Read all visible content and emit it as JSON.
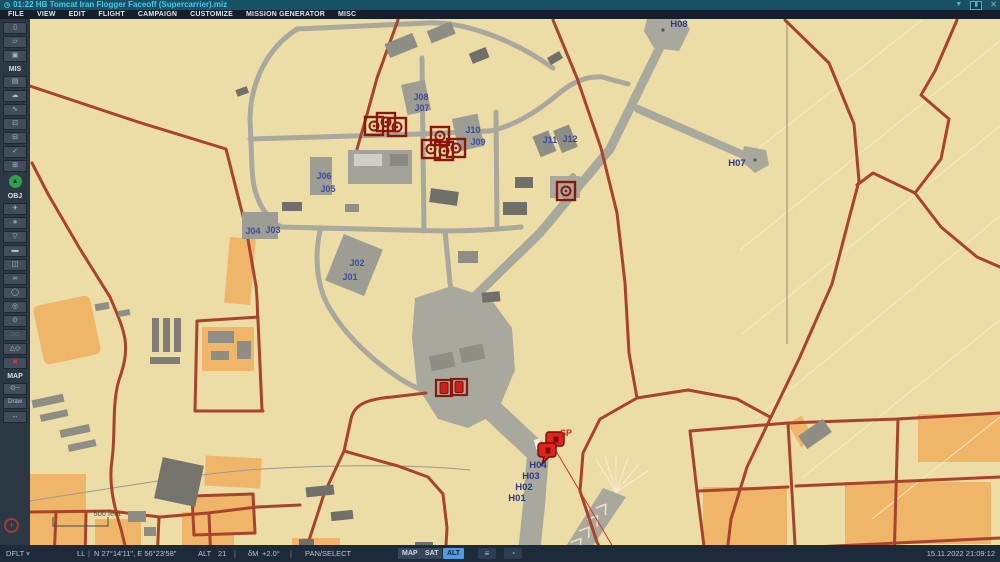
{
  "title_bar": {
    "clock_icon": "◷",
    "title": "01:22 HB Tomcat Iran Flogger Faceoff (Supercarrier).miz",
    "wifi_icon": "▼",
    "controls_icon": "▮",
    "close_icon": "✕"
  },
  "menu": {
    "items": [
      "FILE",
      "VIEW",
      "EDIT",
      "FLIGHT",
      "CAMPAIGN",
      "CUSTOMIZE",
      "MISSION GENERATOR",
      "MISC"
    ]
  },
  "toolbar": {
    "file_items": [
      {
        "name": "new-mission-button",
        "glyph": "▯"
      },
      {
        "name": "open-mission-button",
        "glyph": "▱"
      },
      {
        "name": "save-mission-button",
        "glyph": "▣"
      }
    ],
    "mis_label": "MIS",
    "mis_items": [
      {
        "name": "mission-options-button",
        "glyph": "▤"
      },
      {
        "name": "weather-button",
        "glyph": "☁"
      },
      {
        "name": "route-tool-button",
        "glyph": "∿"
      },
      {
        "name": "goals-button",
        "glyph": "⊡"
      },
      {
        "name": "briefing-button",
        "glyph": "⊟"
      },
      {
        "name": "validate-button",
        "glyph": "✓"
      },
      {
        "name": "triggers-button",
        "glyph": "⊞"
      }
    ],
    "fly_button": {
      "name": "fly-mission-button",
      "glyph": "▲"
    },
    "obj_label": "OBJ",
    "obj_items": [
      {
        "name": "add-airplane-button",
        "glyph": "✈"
      },
      {
        "name": "add-helicopter-button",
        "glyph": "∗"
      },
      {
        "name": "add-ship-button",
        "glyph": "▽"
      },
      {
        "name": "add-vehicle-button",
        "glyph": "▬"
      },
      {
        "name": "add-static-object-button",
        "glyph": "◫"
      },
      {
        "name": "late-activation-button",
        "glyph": "∞"
      },
      {
        "name": "trigger-zone-button",
        "glyph": "◯"
      },
      {
        "name": "template-button",
        "glyph": "◎"
      },
      {
        "name": "bullseye-button",
        "glyph": "⊙"
      },
      {
        "name": "unit-list-button",
        "glyph": "◌◌"
      },
      {
        "name": "draw-shapes-button",
        "glyph": "△◇"
      },
      {
        "name": "delete-object-button",
        "glyph": "✖",
        "red": true
      }
    ],
    "map_label": "MAP",
    "map_items": [
      {
        "name": "map-key-button",
        "glyph": "⊙−"
      },
      {
        "name": "draw-button",
        "glyph": "Draw",
        "text": true
      },
      {
        "name": "measure-distance-button",
        "glyph": "↔"
      }
    ],
    "bullseye_marker": "+"
  },
  "map": {
    "scale_label": "500 feet",
    "labels": [
      {
        "text": "H08",
        "x": 679,
        "y": 27,
        "kind": "h"
      },
      {
        "text": "H07",
        "x": 737,
        "y": 166,
        "kind": "h"
      },
      {
        "text": "J08",
        "x": 421,
        "y": 100,
        "kind": "j"
      },
      {
        "text": "J07",
        "x": 422,
        "y": 111,
        "kind": "j"
      },
      {
        "text": "J10",
        "x": 473,
        "y": 133,
        "kind": "j"
      },
      {
        "text": "J09",
        "x": 478,
        "y": 145,
        "kind": "j"
      },
      {
        "text": "J11",
        "x": 550,
        "y": 143,
        "kind": "j"
      },
      {
        "text": "J12",
        "x": 570,
        "y": 142,
        "kind": "j"
      },
      {
        "text": "J06",
        "x": 324,
        "y": 179,
        "kind": "j"
      },
      {
        "text": "J05",
        "x": 328,
        "y": 192,
        "kind": "j"
      },
      {
        "text": "J04",
        "x": 253,
        "y": 234,
        "kind": "j"
      },
      {
        "text": "J03",
        "x": 273,
        "y": 233,
        "kind": "j"
      },
      {
        "text": "J02",
        "x": 357,
        "y": 266,
        "kind": "j"
      },
      {
        "text": "J01",
        "x": 350,
        "y": 280,
        "kind": "j"
      },
      {
        "text": "H04",
        "x": 538,
        "y": 468,
        "kind": "h"
      },
      {
        "text": "H03",
        "x": 531,
        "y": 479,
        "kind": "h"
      },
      {
        "text": "H02",
        "x": 524,
        "y": 490,
        "kind": "h"
      },
      {
        "text": "H01",
        "x": 517,
        "y": 501,
        "kind": "h"
      },
      {
        "text": "SP",
        "x": 566,
        "y": 436,
        "kind": "sp"
      },
      {
        "text": "500 feet",
        "x": 107,
        "y": 516,
        "kind": "scale"
      }
    ],
    "static_objects": [
      {
        "type": "static-structure-icon",
        "x": 374,
        "y": 126
      },
      {
        "type": "static-structure-icon",
        "x": 386,
        "y": 122
      },
      {
        "type": "static-structure-icon",
        "x": 397,
        "y": 127
      },
      {
        "type": "static-structure-icon",
        "x": 440,
        "y": 136
      },
      {
        "type": "static-structure-icon",
        "x": 431,
        "y": 149
      },
      {
        "type": "static-structure-icon",
        "x": 444,
        "y": 151
      },
      {
        "type": "static-structure-icon",
        "x": 456,
        "y": 148
      },
      {
        "type": "static-structure-icon",
        "x": 566,
        "y": 191
      },
      {
        "type": "cargo-icon",
        "x": 444,
        "y": 388
      },
      {
        "type": "cargo-icon",
        "x": 459,
        "y": 387
      },
      {
        "type": "map-pin",
        "x": 557,
        "y": 446
      },
      {
        "type": "map-pin",
        "x": 549,
        "y": 457
      }
    ],
    "colors": {
      "terrain": "#ecdca6",
      "urban": "#efb568",
      "pavement": "#a9a89d",
      "road": "#a8432d",
      "building": "#8e8e85",
      "unit_red": "#8c150c",
      "pin_red": "#e2231a"
    }
  },
  "status_bar": {
    "preset": "DFLT",
    "preset_caret": "▾",
    "coord_label": "LL",
    "coords": "N 27°14'11\", E 56°23'58\"",
    "alt_label": "ALT",
    "alt_value": "21",
    "mag_label": "δM",
    "mag_value": "+2.0°",
    "mode": "PAN/SELECT",
    "view_buttons": [
      "MAP",
      "SAT",
      "ALT"
    ],
    "active_view": "ALT",
    "scalebar_icon": "≡",
    "grid_icon": "◔",
    "datetime": "15.11.2022 21:09:12"
  }
}
